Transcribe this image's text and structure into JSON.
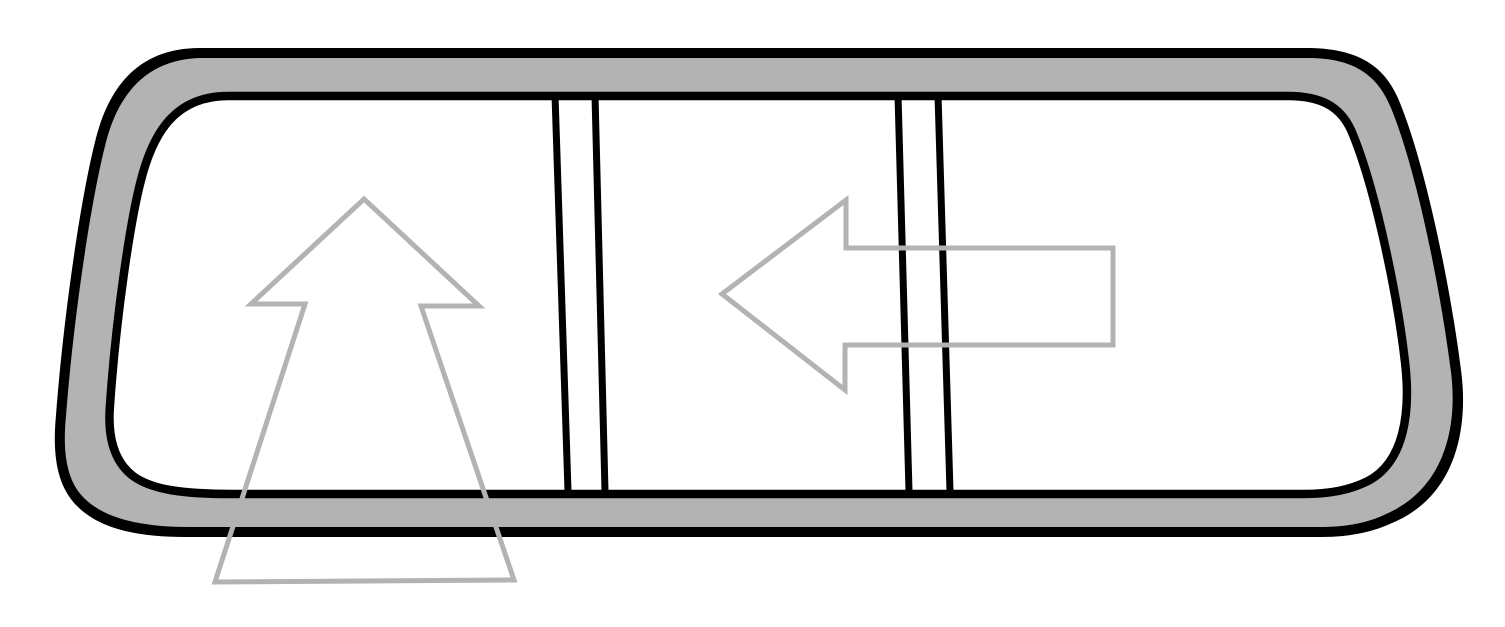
{
  "canvas": {
    "width": 1505,
    "height": 627,
    "viewbox": "0 0 1505 627",
    "background": "#ffffff"
  },
  "colors": {
    "outline": "#000000",
    "seal": "#b3b3b3",
    "glass": "#ffffff",
    "arrow": "#b3b3b3"
  },
  "frame": {
    "outer_path": "M 200,48 L 1310,48 C 1360,49 1386,67 1400,103 C 1426,167 1451,290 1461,370 C 1469,430 1455,497 1392,523 C 1375,531 1352,537 1322,537 L 185,537 C 135,537 98,528 76,505 C 58,486 52,458 56,415 C 63,322 80,200 96,138 C 111,80 144,48 200,48 Z",
    "seal_path": "M 203,58 L 1308,58 C 1355,58 1378,76 1391,108 C 1417,171 1441,293 1451,372 C 1458,428 1444,489 1386,514 C 1370,522 1349,527 1320,527 L 188,527 C 140,527 104,518 84,498 C 68,482 62,456 66,416 C 73,324 90,204 106,142 C 120,88 152,58 203,58 Z",
    "glass_path": "M 228,96 L 1288,96 C 1320,96 1340,106 1351,130 C 1374,183 1397,292 1405,362 C 1411,413 1404,462 1368,481 C 1350,490 1330,494 1303,494 L 232,494 C 184,494 152,490 133,476 C 116,463 107,441 110,405 C 116,318 130,222 141,180 C 153,133 175,96 228,96 Z",
    "glass_stroke_width": 8.5
  },
  "dividers": {
    "stroke_width": 7,
    "lines": [
      {
        "x1": 555,
        "y1": 95,
        "x2": 568,
        "y2": 491
      },
      {
        "x1": 595,
        "y1": 95,
        "x2": 605,
        "y2": 491
      },
      {
        "x1": 898,
        "y1": 95,
        "x2": 909,
        "y2": 491
      },
      {
        "x1": 938,
        "y1": 95,
        "x2": 950,
        "y2": 491
      }
    ]
  },
  "arrows": {
    "stroke_width": 5,
    "up": {
      "direction": "up",
      "points": "364,199 479,306 421,306 514,580 215,582 305,304 251,304"
    },
    "left": {
      "direction": "left",
      "points": "722,294 846,200 846,248 1113,248 1113,345 845,345 845,390"
    }
  }
}
